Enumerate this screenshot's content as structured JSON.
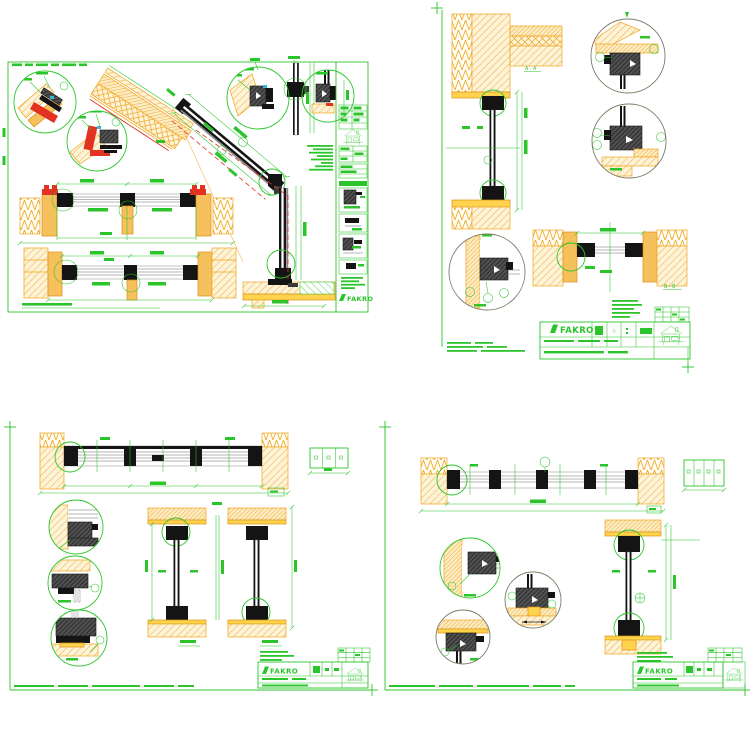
{
  "page": {
    "description": "Set of four green-line CAD installation detail sheets for FAKRO windows (roof-slope section sheet, vertical wall section sheet, three-pane window sheet, four-pane window sheet) on a white background",
    "background_color": "#ffffff"
  },
  "colors": {
    "drawing_green": "#2bc52b",
    "hatch_orange": "#f0a41d",
    "hatch_fill_pale": "#fdf3d8",
    "wood_yellow": "#f6c15c",
    "sill_yellow": "#ffd34d",
    "frame_black": "#141414",
    "profile_dark_gray": "#4d4d4d",
    "seal_red": "#e23222",
    "accent_cyan": "#3ab5d8",
    "detail_circle_gray": "#7c7c66"
  },
  "sheets": {
    "top_left": {
      "logo_text": "FAKRO"
    },
    "top_right": {
      "logo_text": "FAKRO",
      "labels": {
        "section_a": "A - A",
        "section_b": "B - B"
      }
    },
    "bottom_left": {
      "logo_text": "FAKRO"
    },
    "bottom_right": {
      "logo_text": "FAKRO"
    }
  },
  "icons": {
    "house_icon": "house elevation glyph in title blocks",
    "fakro_parallelogram": "slanted bar glyph preceding FAKRO wordmark"
  }
}
